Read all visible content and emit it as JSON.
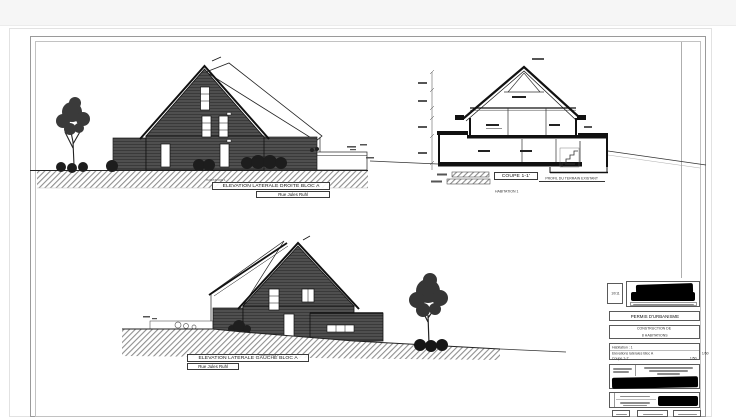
{
  "drawings": {
    "elevation_droite": {
      "title": "ELEVATION LATERALE DROITE BLOC A",
      "street": "Rue Jules Ruhl",
      "ground_label": "HABITATION 1"
    },
    "coupe": {
      "title": "COUPE 1-1'",
      "subtitle": "HABITATION 1",
      "terrain_label": "PROFIL DU TERRAIN EXISTANT"
    },
    "elevation_gauche": {
      "title": "ELEVATION LATERALE GAUCHE BLOC A",
      "street": "Rue Jules Ruhl",
      "ground_label": "HABITATION 1"
    }
  },
  "title_block": {
    "sheet_number": "10/11",
    "permit_title": "PERMIS D'URBANISME",
    "project_line1": "CONSTRUCTION DE",
    "project_line2": "8 HABITATIONS",
    "drawing_list": {
      "habitation": "Habitation : 1",
      "item1_label": "Elévations latérales Bloc A",
      "item1_scale": "1/50",
      "item2_label": "Coupe 1-1'",
      "item2_scale": "1/50"
    }
  },
  "colors": {
    "facade": "#4f4f4f",
    "line": "#111111",
    "redaction": "#000000"
  }
}
